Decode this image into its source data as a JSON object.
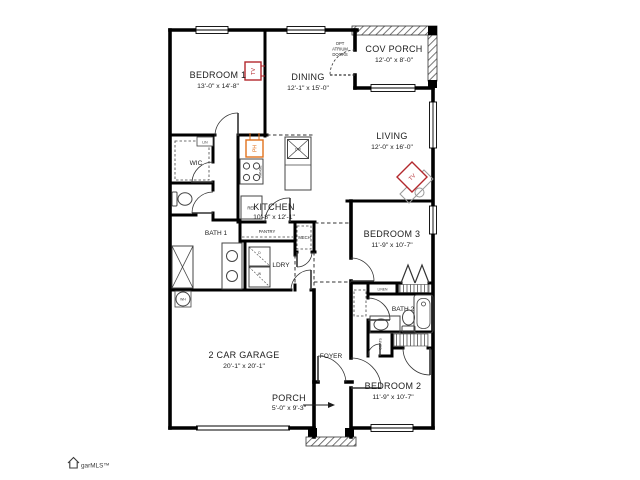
{
  "colors": {
    "wall": "#000000",
    "text": "#1c1c1c",
    "marker_red": "#b3282d",
    "marker_orange": "#e2711d",
    "fixture": "#555555"
  },
  "rooms": {
    "bedroom1": {
      "name": "BEDROOM 1",
      "dims": "13'-0\" x 14'-8\""
    },
    "dining": {
      "name": "DINING",
      "dims": "12'-1\" x 15'-0\""
    },
    "cov_porch": {
      "name": "COV PORCH",
      "dims": "12'-0\" x 8'-0\""
    },
    "living": {
      "name": "LIVING",
      "dims": "12'-0\" x 16'-0\""
    },
    "kitchen": {
      "name": "KITCHEN",
      "dims": "10'-8\" x 12'-1\""
    },
    "wic": {
      "name": "WIC"
    },
    "bath1": {
      "name": "BATH 1"
    },
    "pantry": {
      "name": "PANTRY"
    },
    "mech": {
      "name": "MECH"
    },
    "ldry": {
      "name": "LDRY"
    },
    "bedroom3": {
      "name": "BEDROOM 3",
      "dims": "11'-9\" x 10'-7\""
    },
    "linen": {
      "name": "LINEN"
    },
    "lin": {
      "name": "LIN"
    },
    "bath2": {
      "name": "BATH 2"
    },
    "foyer": {
      "name": "FOYER"
    },
    "coats": {
      "name": "COATS"
    },
    "bedroom2": {
      "name": "BEDROOM 2",
      "dims": "11'-9\" x 10'-7\""
    },
    "garage": {
      "name": "2 CAR GARAGE",
      "dims": "20'-1\" x 20'-1\""
    },
    "porch": {
      "name": "PORCH",
      "dims": "5'-0\" x 9'-3\""
    }
  },
  "labels": {
    "opt_atrium": [
      "OPT",
      "ATRIUM",
      "DOORS"
    ],
    "tv": "TV",
    "ph": "PH",
    "wh": "WH",
    "ref": "REF",
    "range": "RANGE",
    "dw": "DW",
    "dryer": "D",
    "washer": "W"
  },
  "watermark": "garMLS™"
}
